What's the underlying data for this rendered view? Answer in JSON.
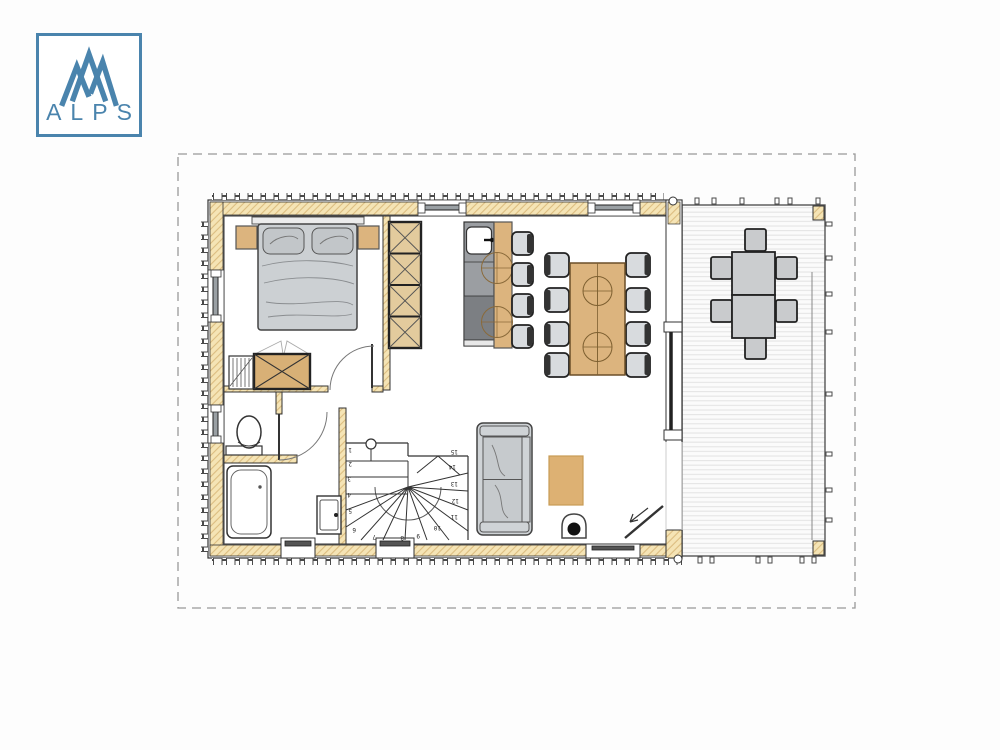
{
  "logo": {
    "text": "ALPS",
    "accent_color": "#4a84ad"
  },
  "floor_plan": {
    "stairs": {
      "steps": [
        "1",
        "2",
        "3",
        "4",
        "5",
        "6",
        "7",
        "8",
        "9",
        "10",
        "11",
        "12",
        "13",
        "14",
        "15"
      ]
    },
    "colors": {
      "wall_insulation_fill": "#f5e4b5",
      "wall_hatch_line": "#dcbd80",
      "wood_furniture": "#dcb47e",
      "wardrobe_wood": "#e3cb9d",
      "chest_wood": "#d8b076",
      "soft_gray_furniture": "#cdd1d4",
      "counter_gray": "#9b9ea2",
      "counter_dark_gray": "#7c7f83",
      "outline": "#3a3a3a",
      "deck_plank_line": "#e2e2e2",
      "dashed_border": "#999999"
    }
  }
}
